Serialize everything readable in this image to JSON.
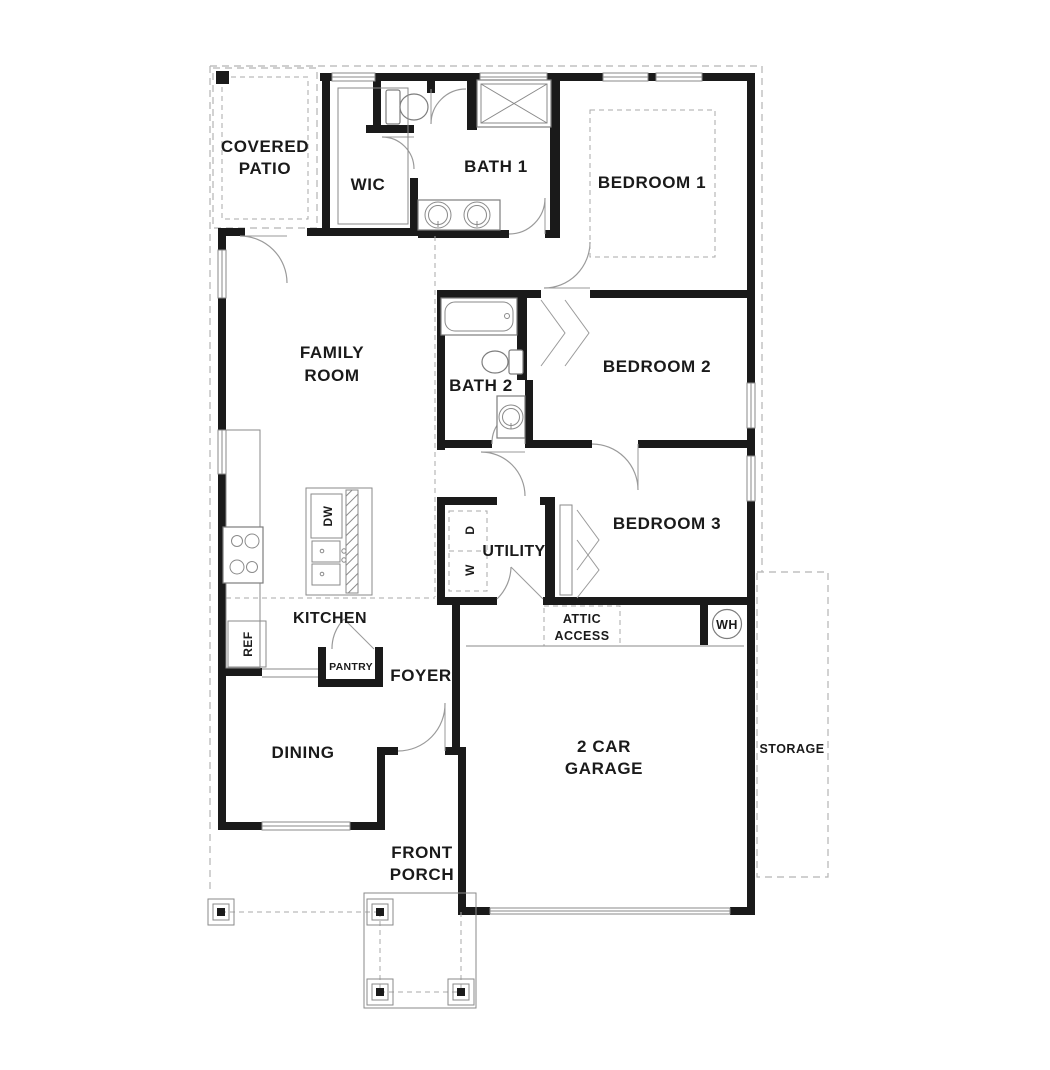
{
  "plan": {
    "title": "single-story house floor plan",
    "rooms": {
      "covered_patio": {
        "line1": "COVERED",
        "line2": "PATIO"
      },
      "wic": "WIC",
      "bath1": "BATH 1",
      "bedroom1": "BEDROOM 1",
      "family_room": {
        "line1": "FAMILY",
        "line2": "ROOM"
      },
      "bath2": "BATH 2",
      "bedroom2": "BEDROOM 2",
      "bedroom3": "BEDROOM 3",
      "utility": "UTILITY",
      "kitchen": "KITCHEN",
      "pantry": "PANTRY",
      "foyer": "FOYER",
      "dining": "DINING",
      "garage": {
        "line1": "2 CAR",
        "line2": "GARAGE"
      },
      "storage": "STORAGE",
      "front_porch": {
        "line1": "FRONT",
        "line2": "PORCH"
      },
      "attic_access": {
        "line1": "ATTIC",
        "line2": "ACCESS"
      }
    },
    "appliances": {
      "dishwasher": "DW",
      "refrigerator": "REF",
      "washer": "W",
      "dryer": "D",
      "water_heater": "WH"
    },
    "colors": {
      "wall": "#1a1a1a",
      "fixture_line": "#8a8a8a",
      "dashed_line": "#b5b5b5",
      "text": "#1a1a1a",
      "background": "#ffffff"
    }
  }
}
